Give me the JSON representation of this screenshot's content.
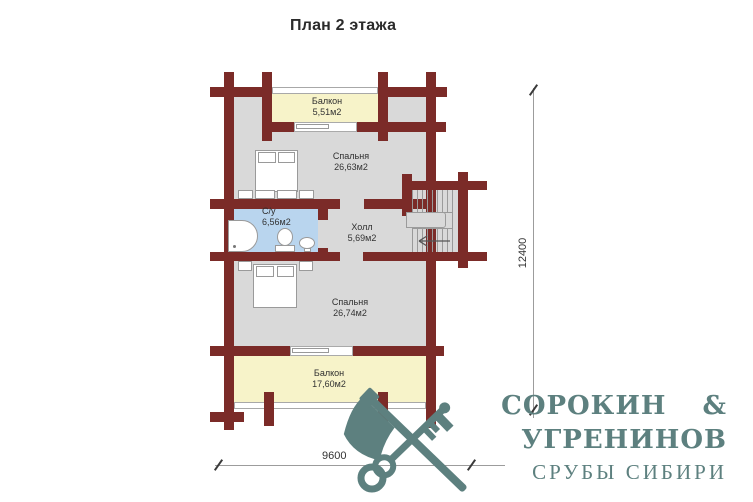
{
  "title": "План 2 этажа",
  "plan": {
    "rooms": {
      "balcony1": {
        "name": "Балкон",
        "area": "5,51м2"
      },
      "bedroom1": {
        "name": "Спальня",
        "area": "26,63м2"
      },
      "bathroom": {
        "name": "С/у",
        "area": "6,56м2"
      },
      "hall": {
        "name": "Холл",
        "area": "5,69м2"
      },
      "bedroom2": {
        "name": "Спальня",
        "area": "26,74м2"
      },
      "balcony2": {
        "name": "Балкон",
        "area": "17,60м2"
      }
    },
    "dimensions": {
      "width": "9600",
      "height": "12400"
    }
  },
  "logo": {
    "line1": "СОРОКИН &",
    "line2": "УГРЕНИНОВ",
    "line3": "СРУБЫ СИБИРИ"
  },
  "colors": {
    "wall": "#7b2b28",
    "room_fill": "#d9d9d9",
    "balcony_fill": "#f7f3c9",
    "bathroom_fill": "#b9d5ee",
    "logo": "#5d807f",
    "dimension_line": "#9c9c9c"
  },
  "icons": [
    "bed-icon",
    "nightstand-icon",
    "shower-icon",
    "toilet-icon",
    "sink-icon",
    "stairs-icon",
    "stairs-arrow-icon",
    "axe-icon",
    "key-icon"
  ]
}
